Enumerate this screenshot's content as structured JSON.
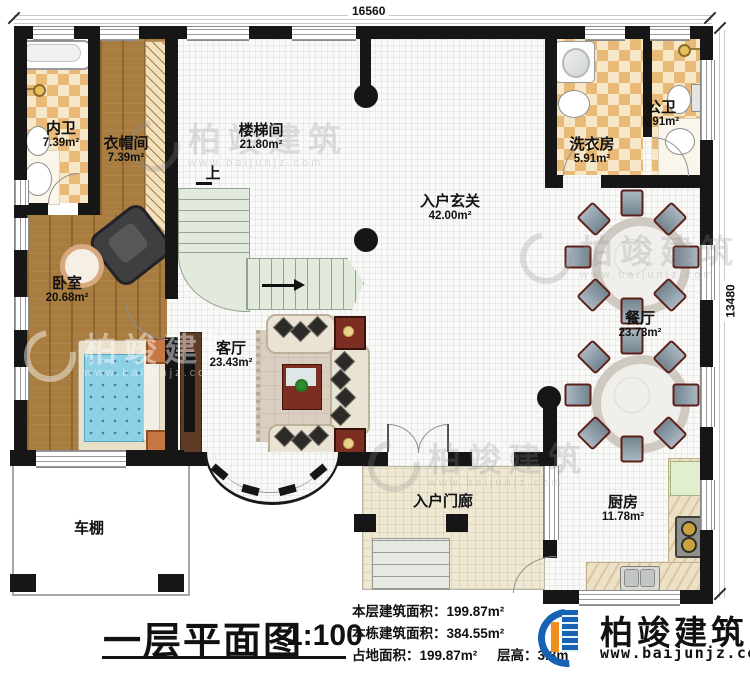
{
  "title": {
    "text": "一层平面图",
    "scale": "1:100"
  },
  "dimensions": {
    "top": "16560",
    "right": "13480"
  },
  "stairs": {
    "up": "上"
  },
  "rooms": {
    "inner_bath": {
      "label": "内卫",
      "area": "7.39m²"
    },
    "cloakroom": {
      "label": "衣帽间",
      "area": "7.39m²"
    },
    "stairwell": {
      "label": "楼梯间",
      "area": "21.80m²"
    },
    "entry_hall": {
      "label": "入户玄关",
      "area": "42.00m²"
    },
    "laundry": {
      "label": "洗衣房",
      "area": "5.91m²"
    },
    "public_bath": {
      "label": "公卫",
      "area": "5.91m²"
    },
    "dining": {
      "label": "餐厅",
      "area": "23.73m²"
    },
    "bedroom": {
      "label": "卧室",
      "area": "20.68m²"
    },
    "living": {
      "label": "客厅",
      "area": "23.43m²"
    },
    "kitchen": {
      "label": "厨房",
      "area": "11.78m²"
    },
    "carport": {
      "label": "车棚"
    },
    "porch": {
      "label": "入户门廊"
    }
  },
  "stats": {
    "line1": "本层建筑面积：199.87m²",
    "line2": "本栋建筑面积：384.55m²",
    "line3": "占地面积：199.87m²",
    "line3b": "层高：3.3m"
  },
  "logo": {
    "name": "柏竣建筑",
    "url": "www.baijunjz.com"
  },
  "watermark": {
    "text": "柏竣建筑",
    "url": "www.baijunjz.com"
  },
  "colors": {
    "wall": "#161616",
    "wood": "#a97c3f",
    "checker_dark": "#e9b977",
    "stair": "#e2eadd",
    "furniture_red": "#7d2e23",
    "logo_blue": "#1762b5",
    "logo_orange": "#ef8d1f"
  }
}
